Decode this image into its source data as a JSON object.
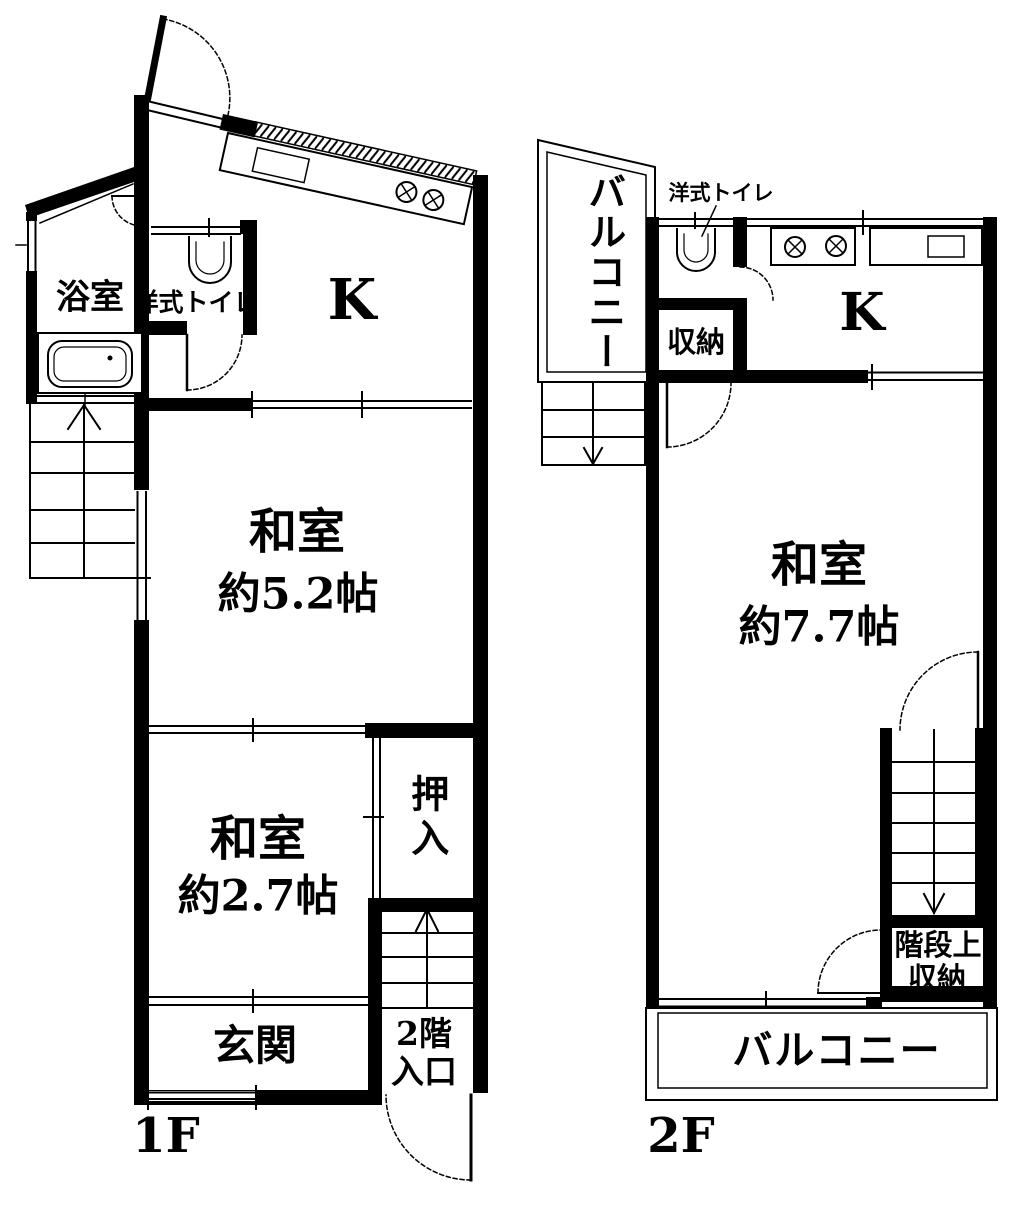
{
  "canvas": {
    "width": 1031,
    "height": 1211,
    "paper_color": "#ffffff",
    "ink_color": "#000000"
  },
  "floor1": {
    "label": "1F",
    "bathroom": "浴室",
    "toilet": "洋式トイレ",
    "kitchen": "K",
    "tatami_room_large": {
      "name": "和室",
      "size": "約5.2帖"
    },
    "tatami_room_small": {
      "name": "和室",
      "size": "約2.7帖"
    },
    "closet": "押入",
    "entrance": "玄関",
    "upstairs_entrance": {
      "line1": "2階",
      "line2": "入口"
    }
  },
  "floor2": {
    "label": "2F",
    "balcony_top": "バルコニー",
    "toilet": "洋式トイレ",
    "storage": "収納",
    "kitchen": "K",
    "tatami_room": {
      "name": "和室",
      "size": "約7.7帖"
    },
    "stair_storage": {
      "line1": "階段上",
      "line2": "収納"
    },
    "balcony_bottom": "バルコニー"
  }
}
